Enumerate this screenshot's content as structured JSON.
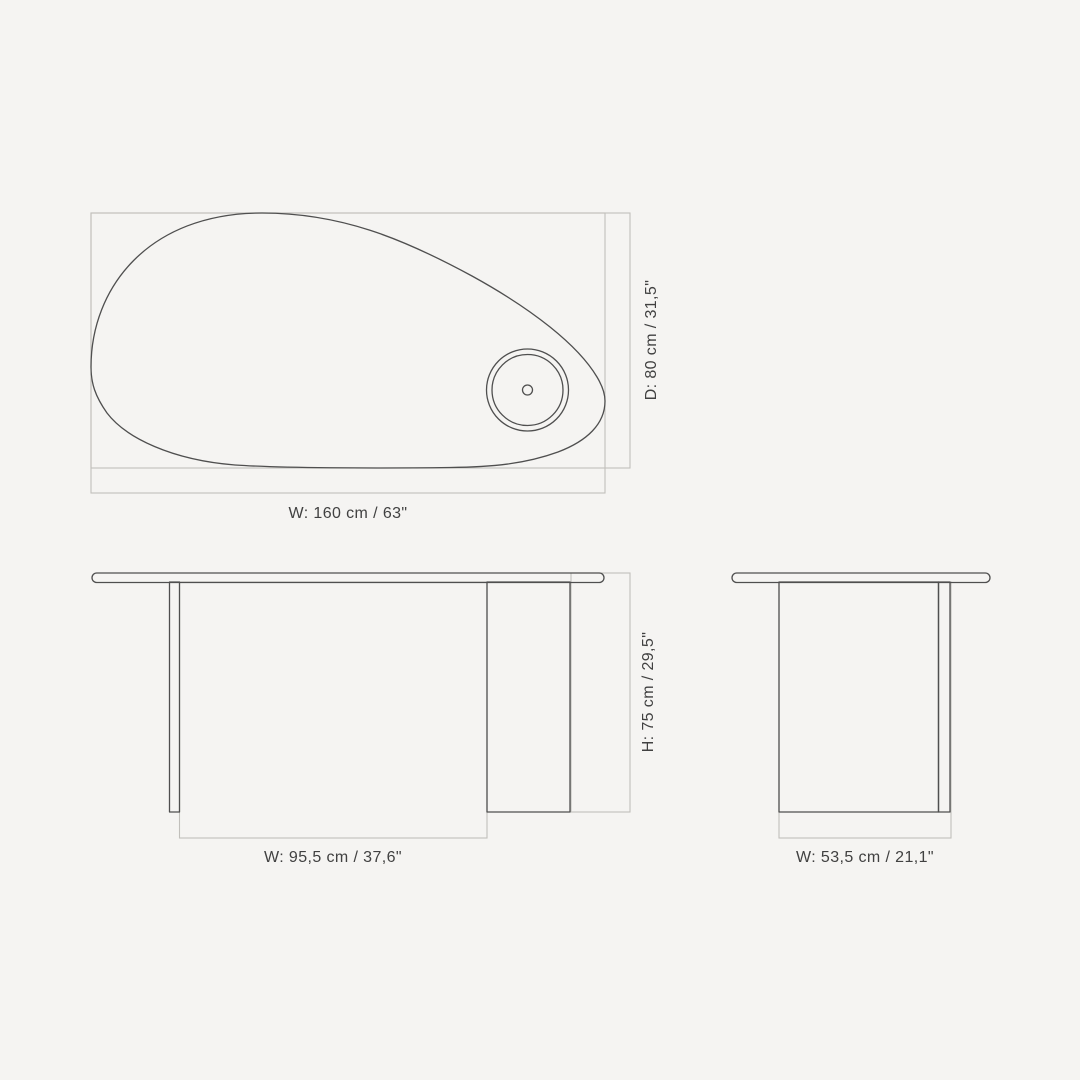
{
  "drawing": {
    "background": "#f5f4f2",
    "outline_color": "#4f4f4f",
    "dimension_line_color": "#c1bfbb",
    "label_color": "#414141",
    "views": {
      "top": {
        "name": "tabletop top view",
        "width_label": "W: 160 cm / 63\"",
        "depth_label": "D: 80 cm / 31,5\"",
        "width_cm": "160",
        "width_in": "63",
        "depth_cm": "80",
        "depth_in": "31,5"
      },
      "front": {
        "name": "table front view",
        "width_label": "W: 95,5 cm / 37,6\"",
        "height_label": "H: 75 cm / 29,5\"",
        "width_cm": "95,5",
        "width_in": "37,6",
        "height_cm": "75",
        "height_in": "29,5"
      },
      "side": {
        "name": "table side view",
        "width_label": "W: 53,5 cm / 21,1\"",
        "width_cm": "53,5",
        "width_in": "21,1"
      }
    }
  }
}
